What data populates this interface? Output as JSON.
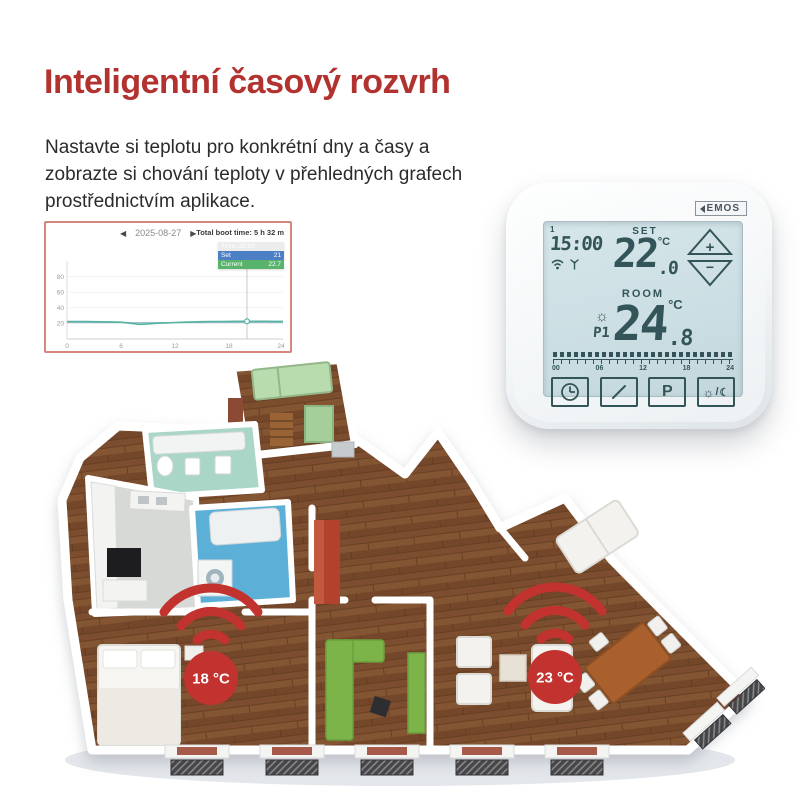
{
  "header": {
    "title": "Inteligentní časový rozvrh"
  },
  "intro": {
    "text": "Nastavte si teplotu pro konkrétní dny a časy a zobrazte si chování teploty v přehledných grafech prostřednictvím aplikace."
  },
  "chart_card": {
    "prev_icon": "◀",
    "next_icon": "▶",
    "date": "2025-08-27",
    "boot_time": "Total boot time: 5 h 32 m",
    "tooltip": {
      "time": "Time: 20:00",
      "set_label": "Set",
      "set_value": "21",
      "current_label": "Current",
      "current_value": "22.7"
    }
  },
  "chart_data": {
    "type": "line",
    "title": "",
    "xlabel": "",
    "ylabel": "",
    "x": [
      0,
      1,
      2,
      3,
      4,
      5,
      6,
      7,
      8,
      9,
      10,
      11,
      12,
      13,
      14,
      15,
      16,
      17,
      18,
      19,
      20,
      21,
      22,
      23,
      24
    ],
    "series": [
      {
        "name": "Set",
        "color": "#8fb6c9",
        "values": [
          21,
          21,
          21,
          21,
          21,
          21,
          21,
          21,
          21,
          21,
          21,
          21,
          21,
          21,
          21,
          21,
          21,
          21,
          21,
          21,
          21,
          21,
          21,
          21,
          21
        ]
      },
      {
        "name": "Current",
        "color": "#56b4a0",
        "values": [
          22.4,
          22.4,
          22.3,
          22.2,
          22.1,
          21.9,
          21.6,
          20.2,
          18.8,
          19.4,
          20.2,
          20.7,
          21.1,
          21.5,
          21.9,
          22.2,
          22.4,
          22.5,
          22.6,
          22.7,
          22.7,
          22.7,
          22.7,
          22.6,
          22.6
        ]
      }
    ],
    "x_ticks": [
      0,
      6,
      12,
      18,
      24
    ],
    "y_ticks_desc": [
      80,
      60,
      40,
      20
    ],
    "xlim": [
      0,
      24
    ],
    "ylim": [
      0,
      100
    ],
    "grid": true,
    "legend": "none",
    "crosshair": {
      "x": 20,
      "value": 22.7
    }
  },
  "thermostat": {
    "brand": "EMOS",
    "day": "1",
    "time": "15:00",
    "set_label": "SET",
    "set_temp": "22",
    "set_decimal": ".0",
    "unit": "°C",
    "room_label": "ROOM",
    "room_temp": "24",
    "room_decimal": ".8",
    "program": "P1",
    "timeline_labels": [
      "00",
      "06",
      "12",
      "18",
      "24"
    ],
    "buttons": {
      "plus": "+",
      "minus": "−",
      "program": "P",
      "day": "☼",
      "slash": "/",
      "night": "☾"
    }
  },
  "floor_plan": {
    "sensors": [
      {
        "label": "18 °C"
      },
      {
        "label": "23 °C"
      }
    ]
  },
  "colors": {
    "accent_red": "#b5312d",
    "lcd_ink": "#33555a",
    "chart_current": "#56b4a0",
    "chart_set": "#8fb6c9"
  }
}
